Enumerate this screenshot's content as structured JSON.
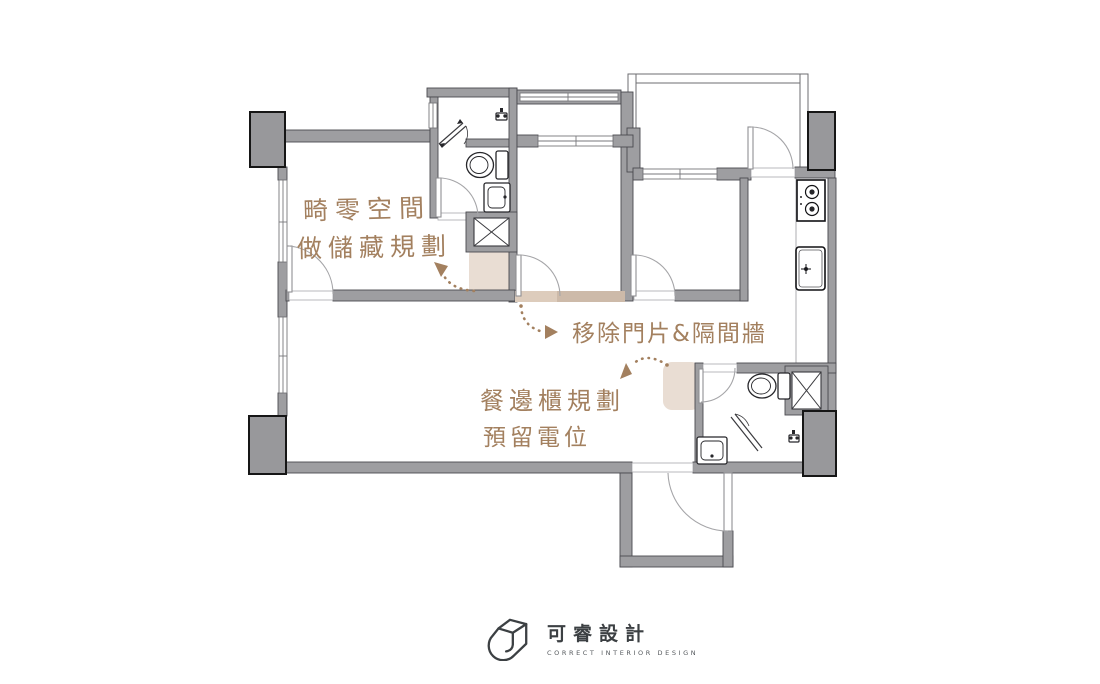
{
  "plan": {
    "annotations": {
      "storage": {
        "line1": "畸零空間",
        "line2": "做儲藏規劃"
      },
      "remove": {
        "text": "移除門片&隔間牆"
      },
      "sideboard": {
        "line1": "餐邊櫃規劃",
        "line2": "預留電位"
      }
    },
    "colors": {
      "annotation_brown": "#a3805f",
      "wall_gray": "#9e9ea1",
      "wall_outline": "#4a4a4f",
      "column_gray": "#98989b",
      "highlight_beige": "#e9ddd3",
      "highlight_tan": "#d2bfae"
    }
  },
  "logo": {
    "title": "可睿設計",
    "subtitle": "CORRECT INTERIOR DESIGN"
  }
}
